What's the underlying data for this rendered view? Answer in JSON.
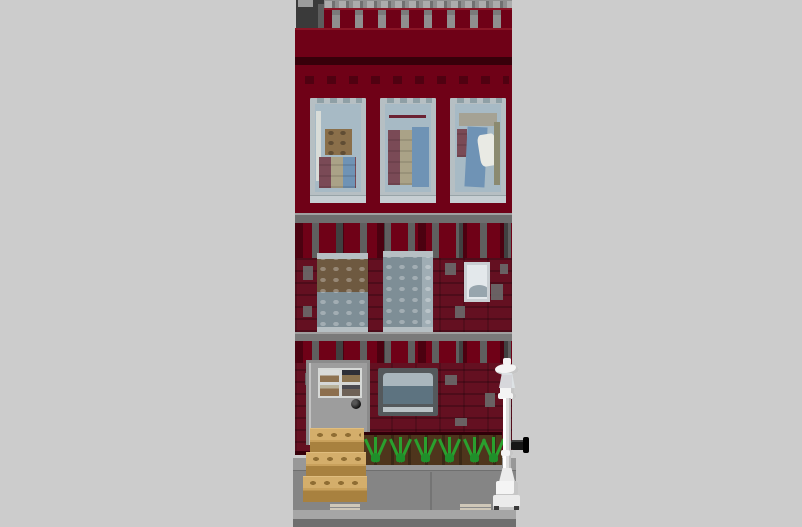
{
  "scene": {
    "subject": "LEGO-style 3D render of a three-story dark red brick townhouse on a plain gray background",
    "parts": [
      "gray-studded-roof-deck",
      "crenellated-parapet",
      "dark-gray-chimney",
      "upper-wall-band",
      "three-top-floor-windows-with-furnished-interiors",
      "gray-floor-ledges",
      "dentil-brick-courses",
      "masonry-middle-floor",
      "two-studded-middle-windows",
      "small-middle-window",
      "ground-floor",
      "gray-front-door-with-four-pane-window",
      "black-door-knob",
      "vent-box-window",
      "dirt-bed-with-grass-tufts",
      "three-tan-front-steps",
      "white-lamp-post",
      "black-wall-pipe",
      "gray-sidewalk-with-curb"
    ],
    "visible_text": []
  },
  "palette": {
    "background": "#cccccc",
    "brick": "#6f0117",
    "brick-light": "#8a1526",
    "brick-dark": "#4a000f",
    "brick-shadow": "#37000a",
    "masonry": "#641021",
    "mortar": "#6a6a6a",
    "dentil-gap": "#5f5f5f",
    "roof-gray": "#8f8f8f",
    "roof-stud": "#acacac",
    "chimney": "#3a3a3a",
    "chimney-cap": "#9c9c9c",
    "ledge": "#6e6e6e",
    "ledge-light": "#a0a0a0",
    "frame": "#b6bfc3",
    "sill": "#c6ced2",
    "glass": "#a7bac5",
    "glass-mid": "#7e8e96",
    "glass-small": "#e3e8eb",
    "interior-tan": "#8a6f4a",
    "interior-brown": "#6e5940",
    "interior-blue": "#6f93b5",
    "interior-red": "#7a4a56",
    "interior-cream": "#aaa287",
    "interior-white": "#e9eae4",
    "interior-olive": "#8b8a70",
    "door": "#9d9d9d",
    "door-frame": "#8b8b8b",
    "muntin": "#d6d8d6",
    "knob": "#111111",
    "vent-frame": "#54595c",
    "vent-top": "#a9b6bd",
    "vent-front": "#5d7380",
    "vent-sill": "#bac3c7",
    "dirt": "#4e351c",
    "grass": "#2aa02e",
    "grass-dark": "#1f8f2a",
    "step-tan": "#c9a15c",
    "step-top": "#d4ae6b",
    "step-face": "#a8813f",
    "step-stud": "#8f6d33",
    "sidewalk": "#858585",
    "sidewalk-top": "#989898",
    "tile-mark": "#cfc7b8",
    "curb": "#a6a6a6",
    "street-dark": "#6e6e6e",
    "lamp-white": "#f4f4f4",
    "lamp-shade": "#c6c6c6",
    "lantern": "#dde3e6",
    "pipe": "#161616"
  }
}
